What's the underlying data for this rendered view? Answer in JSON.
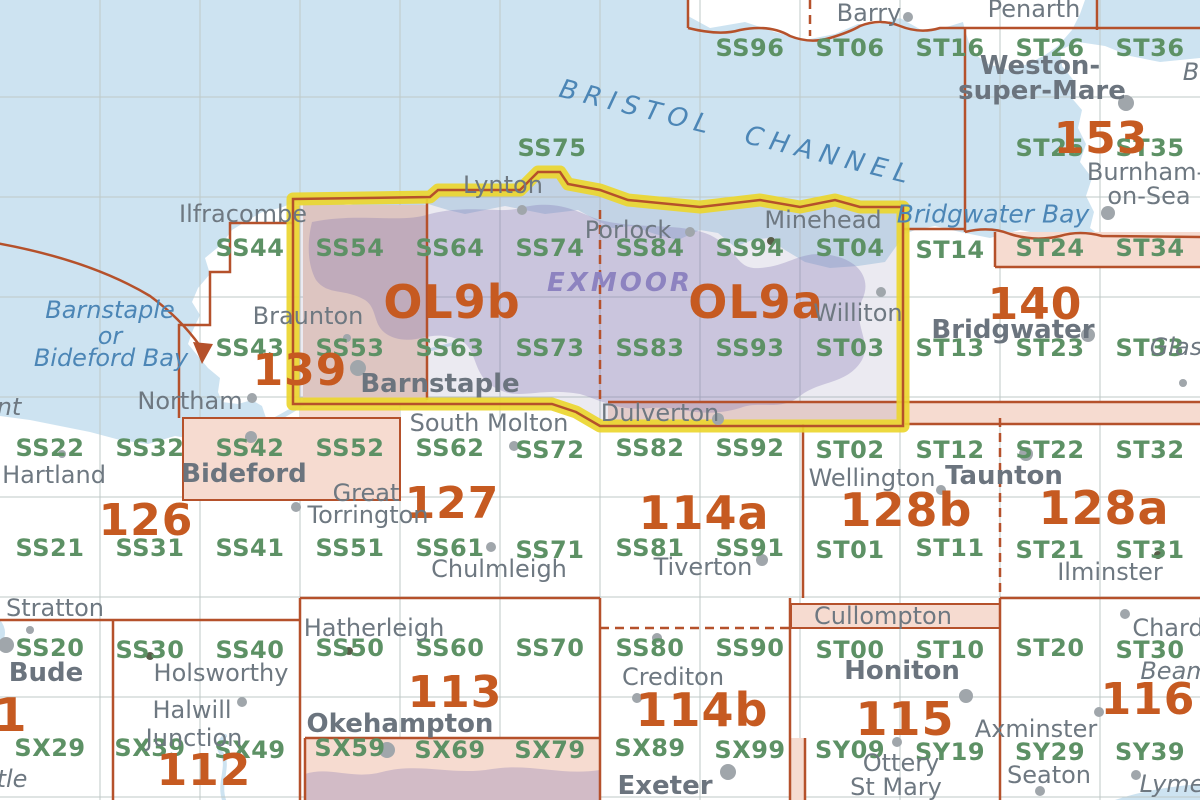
{
  "palette": {
    "sea": "#cde3f1",
    "green": "#5d9165",
    "orange": "#c65a21",
    "gray": "#6e7881",
    "graybold": "#6b747e",
    "seatext": "#4c86b6",
    "parktext": "#8d83c0",
    "redbrown": "#b5512b",
    "yellow": "#ecd62f",
    "pink": "#f6dbd0",
    "dot": "#a0a6ab"
  },
  "sea_labels": [
    {
      "label": "BRISTOL CHANNEL",
      "x": 563,
      "y": 76,
      "size": 26,
      "cls": "channel"
    },
    {
      "label": "Bridgwater Bay",
      "x": 993,
      "y": 214,
      "size": 25,
      "cls": ""
    },
    {
      "label": "Barnstaple",
      "x": 110,
      "y": 310,
      "size": 24,
      "cls": ""
    },
    {
      "label": "or",
      "x": 110,
      "y": 336,
      "size": 24,
      "cls": ""
    },
    {
      "label": "Bideford Bay",
      "x": 111,
      "y": 358,
      "size": 24,
      "cls": ""
    }
  ],
  "park_labels": [
    {
      "label": "EXMOOR",
      "x": 620,
      "y": 283,
      "size": 26
    }
  ],
  "grid_squares": [
    {
      "label": "SS96",
      "x": 750,
      "y": 48
    },
    {
      "label": "ST06",
      "x": 850,
      "y": 48
    },
    {
      "label": "ST16",
      "x": 950,
      "y": 48
    },
    {
      "label": "ST26",
      "x": 1050,
      "y": 48
    },
    {
      "label": "ST36",
      "x": 1150,
      "y": 48
    },
    {
      "label": "SS75",
      "x": 552,
      "y": 148
    },
    {
      "label": "ST25",
      "x": 1050,
      "y": 148
    },
    {
      "label": "ST35",
      "x": 1150,
      "y": 148
    },
    {
      "label": "SS44",
      "x": 250,
      "y": 248
    },
    {
      "label": "SS54",
      "x": 350,
      "y": 248
    },
    {
      "label": "SS64",
      "x": 450,
      "y": 248
    },
    {
      "label": "SS74",
      "x": 550,
      "y": 248
    },
    {
      "label": "SS84",
      "x": 650,
      "y": 248
    },
    {
      "label": "SS94",
      "x": 750,
      "y": 248
    },
    {
      "label": "ST04",
      "x": 850,
      "y": 248
    },
    {
      "label": "ST14",
      "x": 950,
      "y": 250
    },
    {
      "label": "ST24",
      "x": 1050,
      "y": 248
    },
    {
      "label": "ST34",
      "x": 1150,
      "y": 248
    },
    {
      "label": "SS43",
      "x": 250,
      "y": 348
    },
    {
      "label": "SS53",
      "x": 350,
      "y": 348
    },
    {
      "label": "SS63",
      "x": 450,
      "y": 348
    },
    {
      "label": "SS73",
      "x": 550,
      "y": 348
    },
    {
      "label": "SS83",
      "x": 650,
      "y": 348
    },
    {
      "label": "SS93",
      "x": 750,
      "y": 348
    },
    {
      "label": "ST03",
      "x": 850,
      "y": 348
    },
    {
      "label": "ST13",
      "x": 950,
      "y": 348
    },
    {
      "label": "ST23",
      "x": 1050,
      "y": 348
    },
    {
      "label": "ST33",
      "x": 1150,
      "y": 348
    },
    {
      "label": "SS22",
      "x": 50,
      "y": 448
    },
    {
      "label": "SS32",
      "x": 150,
      "y": 448
    },
    {
      "label": "SS42",
      "x": 250,
      "y": 448
    },
    {
      "label": "SS52",
      "x": 350,
      "y": 448
    },
    {
      "label": "SS62",
      "x": 450,
      "y": 448
    },
    {
      "label": "SS72",
      "x": 550,
      "y": 450
    },
    {
      "label": "SS82",
      "x": 650,
      "y": 448
    },
    {
      "label": "SS92",
      "x": 750,
      "y": 448
    },
    {
      "label": "ST02",
      "x": 850,
      "y": 450
    },
    {
      "label": "ST12",
      "x": 950,
      "y": 450
    },
    {
      "label": "ST22",
      "x": 1050,
      "y": 450
    },
    {
      "label": "ST32",
      "x": 1150,
      "y": 450
    },
    {
      "label": "SS21",
      "x": 50,
      "y": 548
    },
    {
      "label": "SS31",
      "x": 150,
      "y": 548
    },
    {
      "label": "SS41",
      "x": 250,
      "y": 548
    },
    {
      "label": "SS51",
      "x": 350,
      "y": 548
    },
    {
      "label": "SS61",
      "x": 450,
      "y": 548
    },
    {
      "label": "SS71",
      "x": 550,
      "y": 550
    },
    {
      "label": "SS81",
      "x": 650,
      "y": 548
    },
    {
      "label": "SS91",
      "x": 750,
      "y": 548
    },
    {
      "label": "ST01",
      "x": 850,
      "y": 550
    },
    {
      "label": "ST11",
      "x": 950,
      "y": 548
    },
    {
      "label": "ST21",
      "x": 1050,
      "y": 550
    },
    {
      "label": "ST31",
      "x": 1150,
      "y": 550
    },
    {
      "label": "SS20",
      "x": 50,
      "y": 648
    },
    {
      "label": "SS30",
      "x": 150,
      "y": 650
    },
    {
      "label": "SS40",
      "x": 250,
      "y": 650
    },
    {
      "label": "SS50",
      "x": 350,
      "y": 648
    },
    {
      "label": "SS60",
      "x": 450,
      "y": 648
    },
    {
      "label": "SS70",
      "x": 550,
      "y": 648
    },
    {
      "label": "SS80",
      "x": 650,
      "y": 648
    },
    {
      "label": "SS90",
      "x": 750,
      "y": 648
    },
    {
      "label": "ST00",
      "x": 850,
      "y": 650
    },
    {
      "label": "ST10",
      "x": 950,
      "y": 650
    },
    {
      "label": "ST20",
      "x": 1050,
      "y": 648
    },
    {
      "label": "ST30",
      "x": 1150,
      "y": 650
    },
    {
      "label": "SX29",
      "x": 50,
      "y": 748
    },
    {
      "label": "SX39",
      "x": 150,
      "y": 748
    },
    {
      "label": "SX49",
      "x": 250,
      "y": 750
    },
    {
      "label": "SX59",
      "x": 350,
      "y": 748
    },
    {
      "label": "SX69",
      "x": 450,
      "y": 750
    },
    {
      "label": "SX79",
      "x": 550,
      "y": 750
    },
    {
      "label": "SX89",
      "x": 650,
      "y": 748
    },
    {
      "label": "SX99",
      "x": 750,
      "y": 750
    },
    {
      "label": "SY09",
      "x": 850,
      "y": 750
    },
    {
      "label": "SY19",
      "x": 950,
      "y": 752
    },
    {
      "label": "SY29",
      "x": 1050,
      "y": 752
    },
    {
      "label": "SY39",
      "x": 1150,
      "y": 752
    }
  ],
  "sheets": [
    {
      "label": "139",
      "x": 300,
      "y": 371,
      "size": 44
    },
    {
      "label": "OL9b",
      "x": 452,
      "y": 302,
      "size": 46
    },
    {
      "label": "OL9a",
      "x": 756,
      "y": 302,
      "size": 46
    },
    {
      "label": "140",
      "x": 1035,
      "y": 305,
      "size": 44
    },
    {
      "label": "153",
      "x": 1101,
      "y": 139,
      "size": 44
    },
    {
      "label": "126",
      "x": 146,
      "y": 521,
      "size": 44
    },
    {
      "label": "127",
      "x": 452,
      "y": 504,
      "size": 44
    },
    {
      "label": "114a",
      "x": 704,
      "y": 513,
      "size": 46
    },
    {
      "label": "128b",
      "x": 906,
      "y": 510,
      "size": 46
    },
    {
      "label": "128a",
      "x": 1104,
      "y": 508,
      "size": 46
    },
    {
      "label": "113",
      "x": 455,
      "y": 693,
      "size": 44
    },
    {
      "label": "114b",
      "x": 702,
      "y": 710,
      "size": 46
    },
    {
      "label": "115",
      "x": 905,
      "y": 719,
      "size": 46
    },
    {
      "label": "116",
      "x": 1148,
      "y": 700,
      "size": 44
    },
    {
      "label": "112",
      "x": 204,
      "y": 771,
      "size": 44
    },
    {
      "label": "1",
      "x": 11,
      "y": 715,
      "size": 46
    }
  ],
  "places": [
    {
      "label": "Ilfracombe",
      "x": 243,
      "y": 214,
      "bold": false
    },
    {
      "label": "Lynton",
      "x": 503,
      "y": 185,
      "bold": false
    },
    {
      "label": "Porlock",
      "x": 628,
      "y": 230,
      "bold": false
    },
    {
      "label": "Minehead",
      "x": 823,
      "y": 220,
      "bold": false
    },
    {
      "label": "Braunton",
      "x": 308,
      "y": 316,
      "bold": false
    },
    {
      "label": "Williton",
      "x": 858,
      "y": 313,
      "bold": false
    },
    {
      "label": "Barnstaple",
      "x": 440,
      "y": 384,
      "bold": true
    },
    {
      "label": "Northam",
      "x": 190,
      "y": 401,
      "bold": false
    },
    {
      "label": "Bideford",
      "x": 244,
      "y": 474,
      "bold": true
    },
    {
      "label": "Hartland",
      "x": 54,
      "y": 475,
      "bold": false
    },
    {
      "label": "Stratton",
      "x": 55,
      "y": 608,
      "bold": false
    },
    {
      "label": "Bude",
      "x": 46,
      "y": 673,
      "bold": true
    },
    {
      "label": "Holsworthy",
      "x": 221,
      "y": 673,
      "bold": false
    },
    {
      "label": "Halwill",
      "x": 192,
      "y": 710,
      "bold": false
    },
    {
      "label": "Junction",
      "x": 194,
      "y": 738,
      "bold": false
    },
    {
      "label": "Hatherleigh",
      "x": 374,
      "y": 628,
      "bold": false
    },
    {
      "label": "Great",
      "x": 366,
      "y": 493,
      "bold": false
    },
    {
      "label": "Torrington",
      "x": 368,
      "y": 515,
      "bold": false
    },
    {
      "label": "South Molton",
      "x": 489,
      "y": 423,
      "bold": false
    },
    {
      "label": "Chulmleigh",
      "x": 499,
      "y": 569,
      "bold": false
    },
    {
      "label": "Tiverton",
      "x": 703,
      "y": 567,
      "bold": false
    },
    {
      "label": "Dulverton",
      "x": 660,
      "y": 413,
      "bold": false
    },
    {
      "label": "Wellington",
      "x": 872,
      "y": 478,
      "bold": false
    },
    {
      "label": "Taunton",
      "x": 1004,
      "y": 476,
      "bold": true
    },
    {
      "label": "Bridgwater",
      "x": 1013,
      "y": 330,
      "bold": true
    },
    {
      "label": "Okehampton",
      "x": 400,
      "y": 724,
      "bold": true
    },
    {
      "label": "Exeter",
      "x": 665,
      "y": 786,
      "bold": true
    },
    {
      "label": "Crediton",
      "x": 673,
      "y": 677,
      "bold": false
    },
    {
      "label": "Cullompton",
      "x": 883,
      "y": 616,
      "bold": false
    },
    {
      "label": "Honiton",
      "x": 902,
      "y": 671,
      "bold": true
    },
    {
      "label": "Ottery",
      "x": 901,
      "y": 763,
      "bold": false
    },
    {
      "label": "St Mary",
      "x": 896,
      "y": 787,
      "bold": false
    },
    {
      "label": "Axminster",
      "x": 1036,
      "y": 729,
      "bold": false
    },
    {
      "label": "Seaton",
      "x": 1049,
      "y": 775,
      "bold": false
    },
    {
      "label": "Chard",
      "x": 1168,
      "y": 628,
      "bold": false
    },
    {
      "label": "Ilminster",
      "x": 1110,
      "y": 572,
      "bold": false
    },
    {
      "label": "Weston-",
      "x": 1040,
      "y": 66,
      "bold": true
    },
    {
      "label": "super-Mare",
      "x": 1042,
      "y": 91,
      "bold": true
    },
    {
      "label": "Burnham-",
      "x": 1146,
      "y": 172,
      "bold": false
    },
    {
      "label": "on-Sea",
      "x": 1149,
      "y": 196,
      "bold": false
    },
    {
      "label": "Barry",
      "x": 869,
      "y": 13,
      "bold": false
    },
    {
      "label": "Penarth",
      "x": 1034,
      "y": 9,
      "bold": false
    }
  ],
  "fragments": [
    {
      "label": "nt",
      "x": 9,
      "y": 407
    },
    {
      "label": "tle",
      "x": 12,
      "y": 779
    },
    {
      "label": "Glas",
      "x": 1176,
      "y": 347
    },
    {
      "label": "Beam",
      "x": 1175,
      "y": 671
    },
    {
      "label": "Lyme",
      "x": 1172,
      "y": 784
    },
    {
      "label": "B",
      "x": 1191,
      "y": 72
    }
  ],
  "dots": [
    {
      "x": 522,
      "y": 210,
      "r": 5
    },
    {
      "x": 690,
      "y": 232,
      "r": 5
    },
    {
      "x": 771,
      "y": 241,
      "r": 4,
      "dark": true
    },
    {
      "x": 881,
      "y": 292,
      "r": 5
    },
    {
      "x": 1126,
      "y": 103,
      "r": 8
    },
    {
      "x": 1108,
      "y": 213,
      "r": 7
    },
    {
      "x": 908,
      "y": 17,
      "r": 5
    },
    {
      "x": 1088,
      "y": 335,
      "r": 7
    },
    {
      "x": 1183,
      "y": 383,
      "r": 4
    },
    {
      "x": 358,
      "y": 368,
      "r": 8
    },
    {
      "x": 347,
      "y": 338,
      "r": 4
    },
    {
      "x": 252,
      "y": 398,
      "r": 5
    },
    {
      "x": 62,
      "y": 454,
      "r": 4
    },
    {
      "x": 251,
      "y": 437,
      "r": 6
    },
    {
      "x": 296,
      "y": 507,
      "r": 5
    },
    {
      "x": 514,
      "y": 446,
      "r": 5
    },
    {
      "x": 491,
      "y": 547,
      "r": 5
    },
    {
      "x": 762,
      "y": 560,
      "r": 6
    },
    {
      "x": 718,
      "y": 419,
      "r": 6
    },
    {
      "x": 941,
      "y": 490,
      "r": 5
    },
    {
      "x": 1026,
      "y": 454,
      "r": 7
    },
    {
      "x": 30,
      "y": 630,
      "r": 4
    },
    {
      "x": 6,
      "y": 645,
      "r": 8
    },
    {
      "x": 150,
      "y": 656,
      "r": 4,
      "dark": true
    },
    {
      "x": 242,
      "y": 702,
      "r": 5
    },
    {
      "x": 349,
      "y": 651,
      "r": 4,
      "dark": true
    },
    {
      "x": 387,
      "y": 750,
      "r": 8
    },
    {
      "x": 637,
      "y": 698,
      "r": 5
    },
    {
      "x": 657,
      "y": 638,
      "r": 5
    },
    {
      "x": 728,
      "y": 772,
      "r": 8
    },
    {
      "x": 966,
      "y": 696,
      "r": 7
    },
    {
      "x": 897,
      "y": 742,
      "r": 5
    },
    {
      "x": 1040,
      "y": 791,
      "r": 5
    },
    {
      "x": 1099,
      "y": 712,
      "r": 5
    },
    {
      "x": 1125,
      "y": 614,
      "r": 5
    },
    {
      "x": 1136,
      "y": 775,
      "r": 5
    },
    {
      "x": 1158,
      "y": 555,
      "r": 4,
      "dark": true
    }
  ]
}
